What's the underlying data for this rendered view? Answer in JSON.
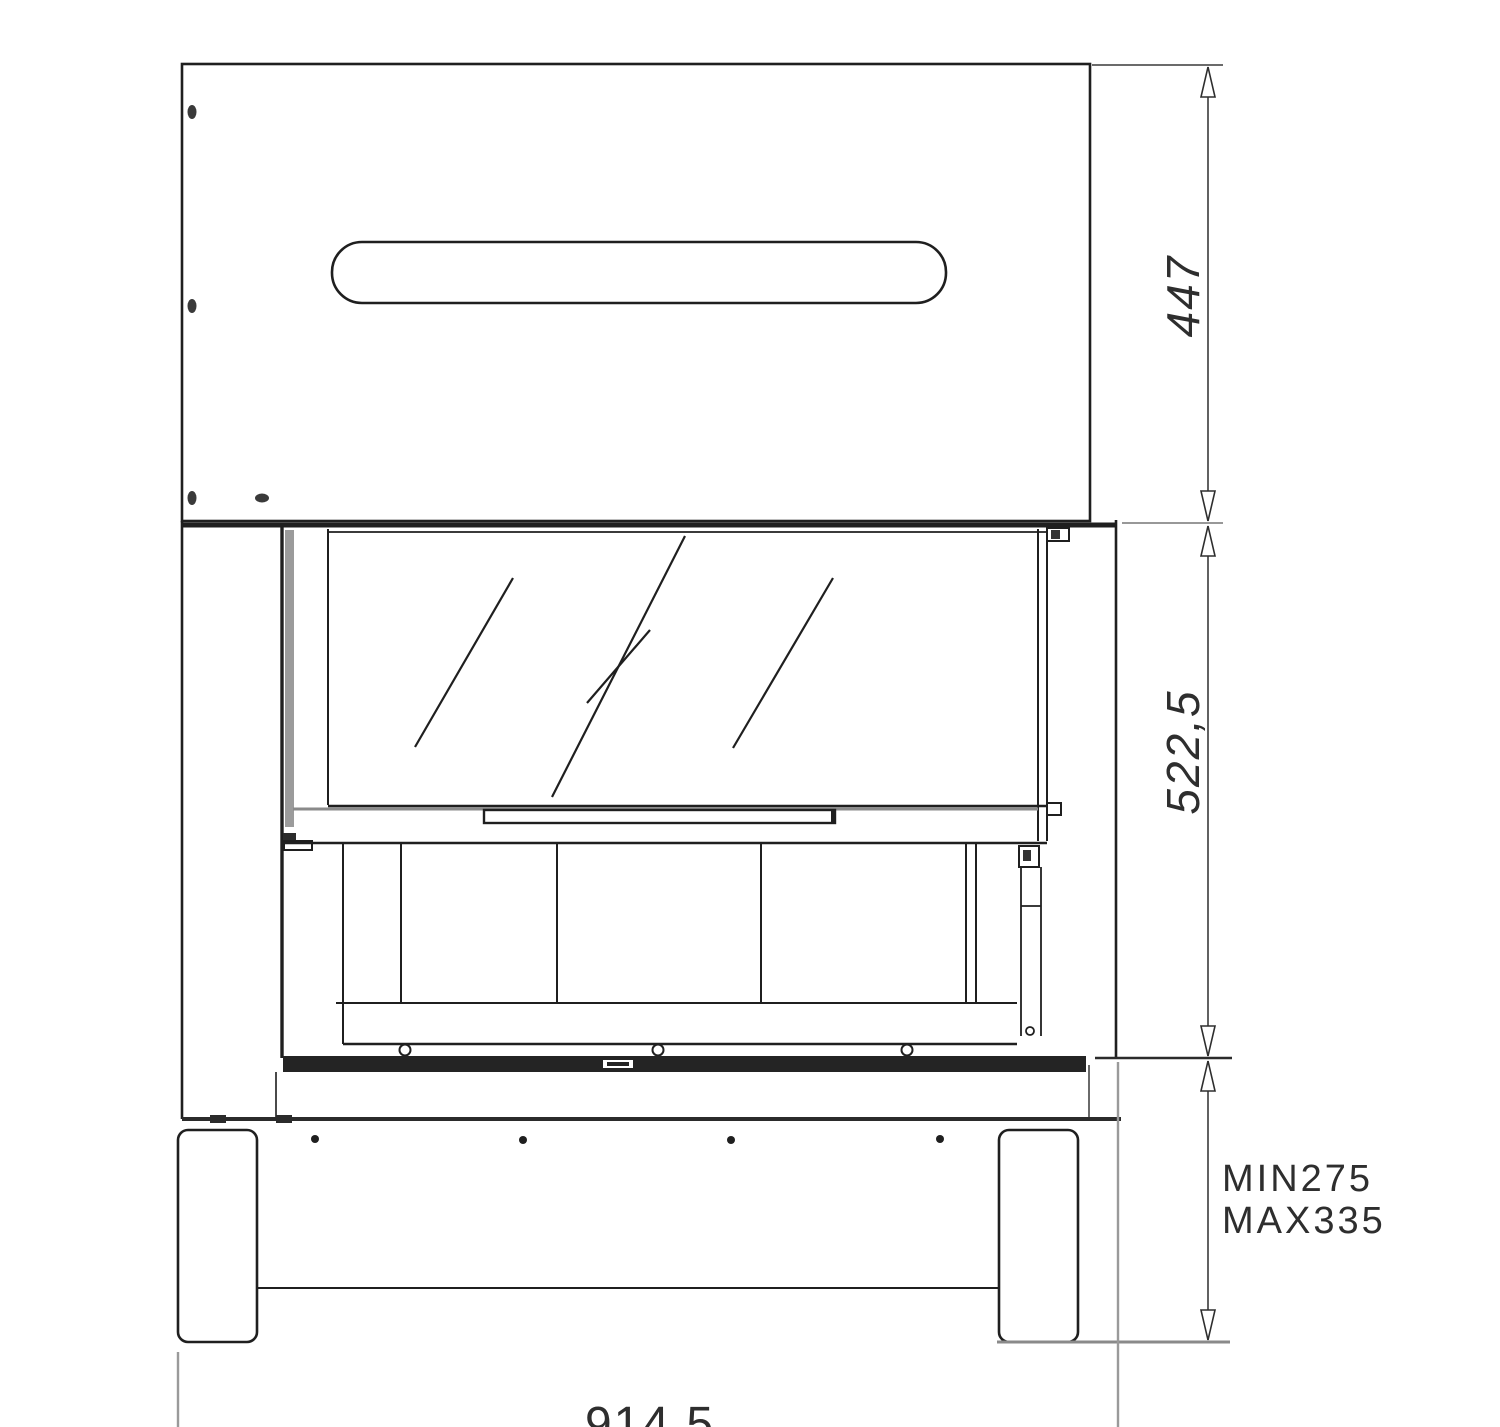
{
  "page": {
    "background": "#ffffff"
  },
  "drawing": {
    "kind": "fireplace-front-elevation-technical-drawing",
    "colors": {
      "line": "#1f1f1f",
      "dimension": "#3a3a3a",
      "extension": "#9a9a9a",
      "glass_channel": "#9b9b9b",
      "base_strip": "#242424"
    },
    "dimensions": {
      "upper_section_height": {
        "label": "447"
      },
      "door_section_height": {
        "label": "522,5"
      },
      "plinth_min": {
        "label": "MIN275"
      },
      "plinth_max": {
        "label": "MAX335"
      },
      "overall_width": {
        "label": "914,5"
      }
    }
  }
}
